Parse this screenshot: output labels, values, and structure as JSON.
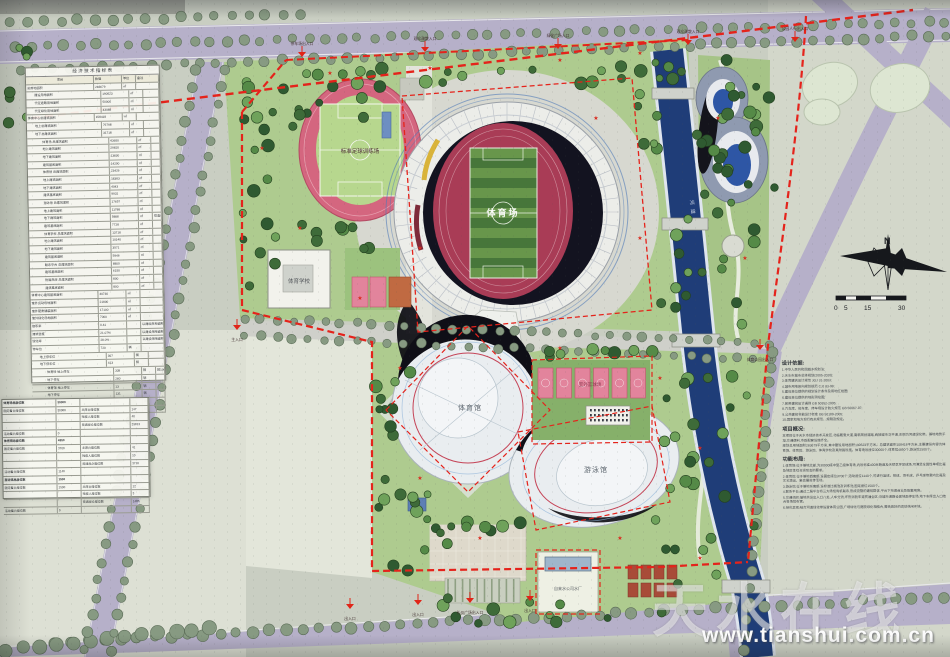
{
  "watermark": {
    "brand": "天水在线",
    "url": "www.tianshui.com.cn"
  },
  "compass": {
    "north_label": "N"
  },
  "scalebar": {
    "labels": [
      "0",
      "5",
      "15",
      "30"
    ]
  },
  "map_labels": {
    "stadium": "体育场",
    "gymnasium": "体育馆",
    "natatorium": "游泳馆",
    "platform": "联系平台",
    "training_field": "标准足球训练场",
    "sports_school": "体育学校",
    "outdoor_courts": "室外篮球场",
    "water_plant": "自来水公司水厂",
    "river": "河道"
  },
  "entrances": {
    "labels": [
      "停车场出入口",
      "观众疏散入口",
      "绿化广场入口",
      "观众疏散入口",
      "公园人行出入口",
      "主入口",
      "体育公园出入口",
      "出入口",
      "礼仪广场出入口",
      "出入口",
      "出入口"
    ]
  },
  "tables": {
    "indicators": {
      "title": "经 济 技 术 指 标 表",
      "headers": [
        "项目",
        "数值",
        "单位",
        "备注"
      ],
      "rows": [
        [
          0,
          "总用地面积",
          "283679",
          "㎡",
          ""
        ],
        [
          1,
          "建设用地面积",
          "190523",
          "㎡",
          ""
        ],
        [
          1,
          "代征道路用地面积",
          "50000",
          "㎡",
          ""
        ],
        [
          1,
          "代征绿化用地面积",
          "43088",
          "㎡",
          ""
        ],
        [
          0,
          "体育中心总建筑面积",
          "108418",
          "㎡",
          ""
        ],
        [
          1,
          "地上总建筑面积",
          "76798",
          "㎡",
          ""
        ],
        [
          1,
          "地下总建筑面积",
          "31718",
          "㎡",
          ""
        ],
        [
          2,
          "体育场 总建筑面积",
          "43650",
          "㎡",
          ""
        ],
        [
          2,
          "地上建筑面积",
          "29820",
          "㎡",
          ""
        ],
        [
          2,
          "地下建筑面积",
          "13830",
          "㎡",
          ""
        ],
        [
          2,
          "建筑基底面积",
          "14200",
          "㎡",
          ""
        ],
        [
          2,
          "体育馆 总建筑面积",
          "23426",
          "㎡",
          ""
        ],
        [
          2,
          "地上建筑面积",
          "18383",
          "㎡",
          ""
        ],
        [
          2,
          "地下建筑面积",
          "4043",
          "㎡",
          ""
        ],
        [
          2,
          "建筑基底面积",
          "9931",
          "㎡",
          ""
        ],
        [
          2,
          "游泳馆 总建筑面积",
          "17657",
          "㎡",
          ""
        ],
        [
          2,
          "地上建筑面积",
          "11788",
          "㎡",
          ""
        ],
        [
          2,
          "地下建筑面积",
          "5888",
          "㎡",
          "恒温设备机房计入地下建筑面积"
        ],
        [
          2,
          "建筑基底面积",
          "7728",
          "㎡",
          ""
        ],
        [
          2,
          "体育学校 总建筑面积",
          "13718",
          "㎡",
          ""
        ],
        [
          2,
          "地上建筑面积",
          "10140",
          "㎡",
          ""
        ],
        [
          2,
          "地下建筑面积",
          "3571",
          "㎡",
          ""
        ],
        [
          2,
          "建筑基底面积",
          "5946",
          "㎡",
          ""
        ],
        [
          2,
          "联系平台 总建筑面积",
          "8800",
          "㎡",
          ""
        ],
        [
          2,
          "建筑基底面积",
          "6150",
          "㎡",
          ""
        ],
        [
          2,
          "附属用房 总建筑面积",
          "800",
          "㎡",
          ""
        ],
        [
          2,
          "建筑基底面积",
          "800",
          "㎡",
          ""
        ],
        [
          0,
          "体育中心建筑基底面积",
          "40730",
          "㎡",
          ""
        ],
        [
          0,
          "室外运动场地面积",
          "21800",
          "㎡",
          ""
        ],
        [
          0,
          "室外硬质铺装面积",
          "17100",
          "㎡",
          ""
        ],
        [
          0,
          "室外绿化场地面积",
          "7000",
          "㎡",
          ""
        ],
        [
          0,
          "容积率",
          "0.41",
          "",
          "以建设用地面积计算"
        ],
        [
          0,
          "建筑密度",
          "21.07%",
          "",
          "以建设用地面积计算"
        ],
        [
          0,
          "绿化率",
          "28.0%",
          "",
          "以建设用地面积计算"
        ],
        [
          0,
          "停车位",
          "720",
          "辆",
          ""
        ],
        [
          1,
          "地上停车位",
          "307",
          "辆",
          ""
        ],
        [
          1,
          "地下停车位",
          "413",
          "辆",
          ""
        ],
        [
          2,
          "体育场 地上停车",
          "339",
          "辆",
          "按100人2.5个车位配建小型车"
        ],
        [
          2,
          "地下停车",
          "280",
          "辆",
          ""
        ],
        [
          2,
          "体育馆 地上停车",
          "13",
          "辆",
          ""
        ],
        [
          2,
          "地下停车",
          "131",
          "辆",
          ""
        ],
        [
          2,
          "游泳馆 地上停车",
          "65",
          "辆",
          ""
        ],
        [
          2,
          "体育学校 地上停车",
          "17",
          "辆",
          ""
        ]
      ]
    },
    "seats": {
      "sections": [
        {
          "title": "体育场总座位数",
          "total": "30000",
          "fixed_label": "固定看台座位数",
          "fixed_value": "30000",
          "sub": [
            [
              "主席台座位数",
              "147"
            ],
            [
              "残疾人座位数",
              "40"
            ],
            [
              "普通观众座位数",
              "29813"
            ]
          ],
          "movable_label": "活动看台座位数",
          "movable_value": "0"
        },
        {
          "title": "体育馆总座位数",
          "total": "4850",
          "fixed_label": "固定看台座位数",
          "fixed_value": "3700",
          "sub": [
            [
              "主席台座位数",
              "41"
            ],
            [
              "残疾人座位数",
              "10"
            ],
            [
              "普通观众座位数",
              "3710"
            ]
          ],
          "movable_label": "活动看台座位数",
          "movable_value": "1140"
        },
        {
          "title": "游泳馆总座位数",
          "total": "1500",
          "fixed_label": "固定看台座位数",
          "fixed_value": "1500",
          "sub": [
            [
              "主席台座位数",
              "12"
            ],
            [
              "残疾人座位数",
              "3"
            ],
            [
              "普通观众座位数",
              "1485"
            ]
          ],
          "movable_label": "活动看台座位数",
          "movable_value": "0"
        }
      ]
    }
  },
  "notes": {
    "sections": [
      {
        "heading": "设计依据:",
        "lines": [
          "1.中华人民共和国城乡规划法;",
          "2.天水市城市总体规划(2005-2020);",
          "3.体育建筑设计规范 JGJ 31-2003;",
          "4.城市用地竖向规划规范 CJJ 83-99;",
          "5.建设单位提供的规划设计条件及用地红线图;",
          "6.建设单位提供的地形测绘图;",
          "7.民用建筑设计通则 GB 50352-2005;",
          "8.汽车库、修车库、停车场设计防火规范 GB 50067-97;",
          "9.公共建筑节能设计标准 GB 50189-2005;",
          "10.国家和地方现行有关规范、规程及规定。"
        ]
      },
      {
        "heading": "项目概况:",
        "lines": [
          "本项目位于天水市经济技术开发区,北临羲皇大道,南临规划道路,西接城市次干道,东侧为河道绿化带。基地地势平坦,交通便利,市政配套设施齐全。",
          "规划总用地面积283679平方米,其中建设用地面积190523平方米。总建筑面积108418平方米,主要建设内容为体育场、体育馆、游泳馆、体育学校及其附属设施。体育场设座位30000个,体育馆4850个,游泳馆1500个。"
        ]
      },
      {
        "heading": "功能布局:",
        "lines": [
          "1.体育场:位于基地北部,为30000座中型乙级体育场,内设标准400米跑道及天然草坪足球场,可满足全国性单项比赛及地区性综合运动会的要求。",
          "2.体育馆:位于基地西南部,设固定座位3700个,活动座位1140个,可进行篮球、排球、羽毛球、乒乓球等室内比赛及文艺演出、集会展览等活动。",
          "3.游泳馆:位于基地东南部,设标准比赛池及训练池,固定座位1500个。",
          "4.联系平台:通过二层平台将三大场馆有机联系,形成完整的建筑群体,平台下布置商业及配套用房。",
          "5.交通组织:基地共设出入口八处,人车分流,环形消防车道贯通全区;沿城市道路设置地面停车场,地下车库出入口结合各场馆布置。",
          "6.绿化景观:结合河道绿化带设置体育公园,广场绿化与庭院绿化相结合,营造良好的运动休闲环境。"
        ]
      }
    ]
  }
}
